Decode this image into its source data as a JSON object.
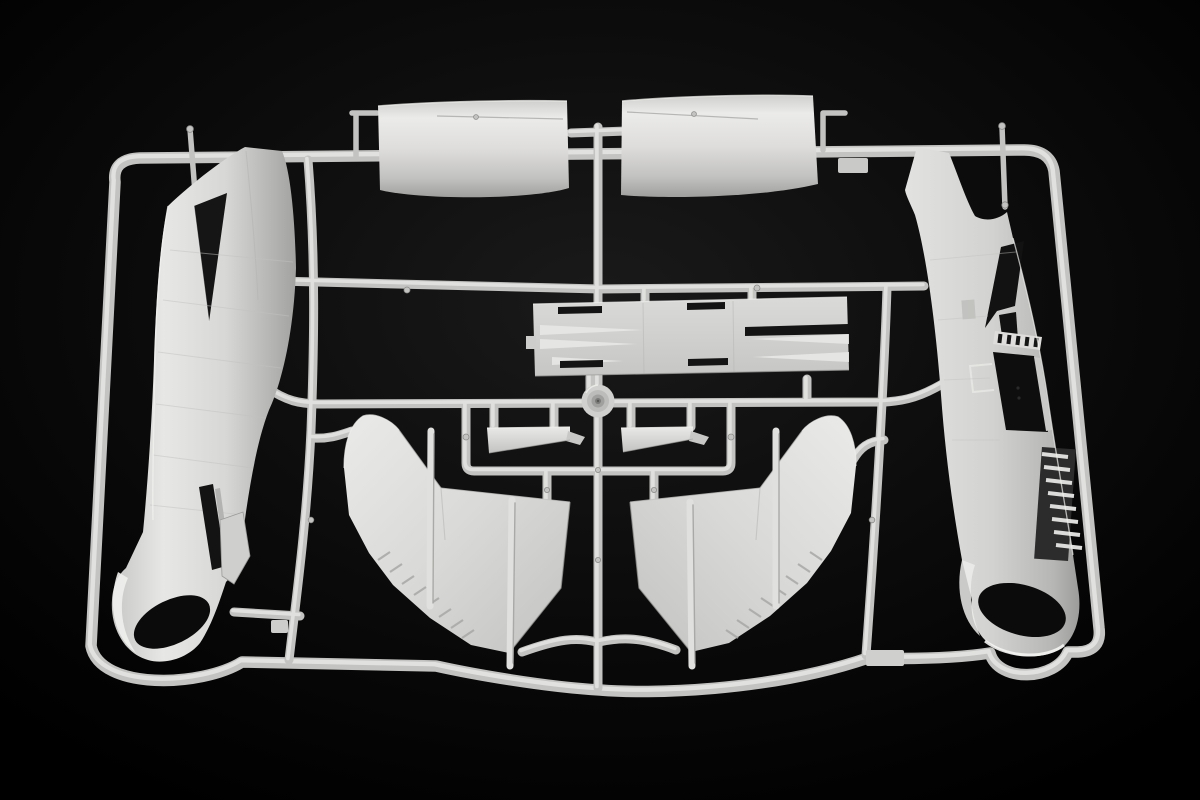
{
  "scene": {
    "type": "photograph",
    "description": "Light-grey injection-moulded model aircraft sprue (parts tree) photographed on a black studio background: two fuselage halves at the sides, two engine cowling halves at the top, a wing centre-section panel, two tailplane halves, a wheel hub disc, two large outer wing panels and four long strut rods, all attached to a rectangular runner frame.",
    "colors": {
      "background_center": "#1a1a1a",
      "background_edge": "#000000",
      "runner_base": "#c3c3c1",
      "runner_highlight": "#e6e6e4",
      "plastic_light": "#ececea",
      "plastic_mid": "#d3d3d1",
      "plastic_shadow": "#a2a2a0",
      "opening_dark": "#111111"
    },
    "parts": [
      {
        "name": "sprue-frame",
        "label": "Sprue frame and runners"
      },
      {
        "name": "engine-cowling-left",
        "label": "Engine cowling half (left)"
      },
      {
        "name": "engine-cowling-right",
        "label": "Engine cowling half (right)"
      },
      {
        "name": "fuselage-half-left",
        "label": "Fuselage half, exterior face"
      },
      {
        "name": "fuselage-half-right",
        "label": "Fuselage half, interior face"
      },
      {
        "name": "wing-center-panel",
        "label": "Wing centre-section flap panel"
      },
      {
        "name": "hub-disc",
        "label": "Wheel hub disc"
      },
      {
        "name": "tailplane-left",
        "label": "Tailplane half (left)"
      },
      {
        "name": "tailplane-right",
        "label": "Tailplane half (right)"
      },
      {
        "name": "wing-panel-left",
        "label": "Outer wing panel (left)"
      },
      {
        "name": "wing-panel-right",
        "label": "Outer wing panel (right)"
      },
      {
        "name": "strut-rods",
        "label": "Long strut rods"
      }
    ]
  }
}
